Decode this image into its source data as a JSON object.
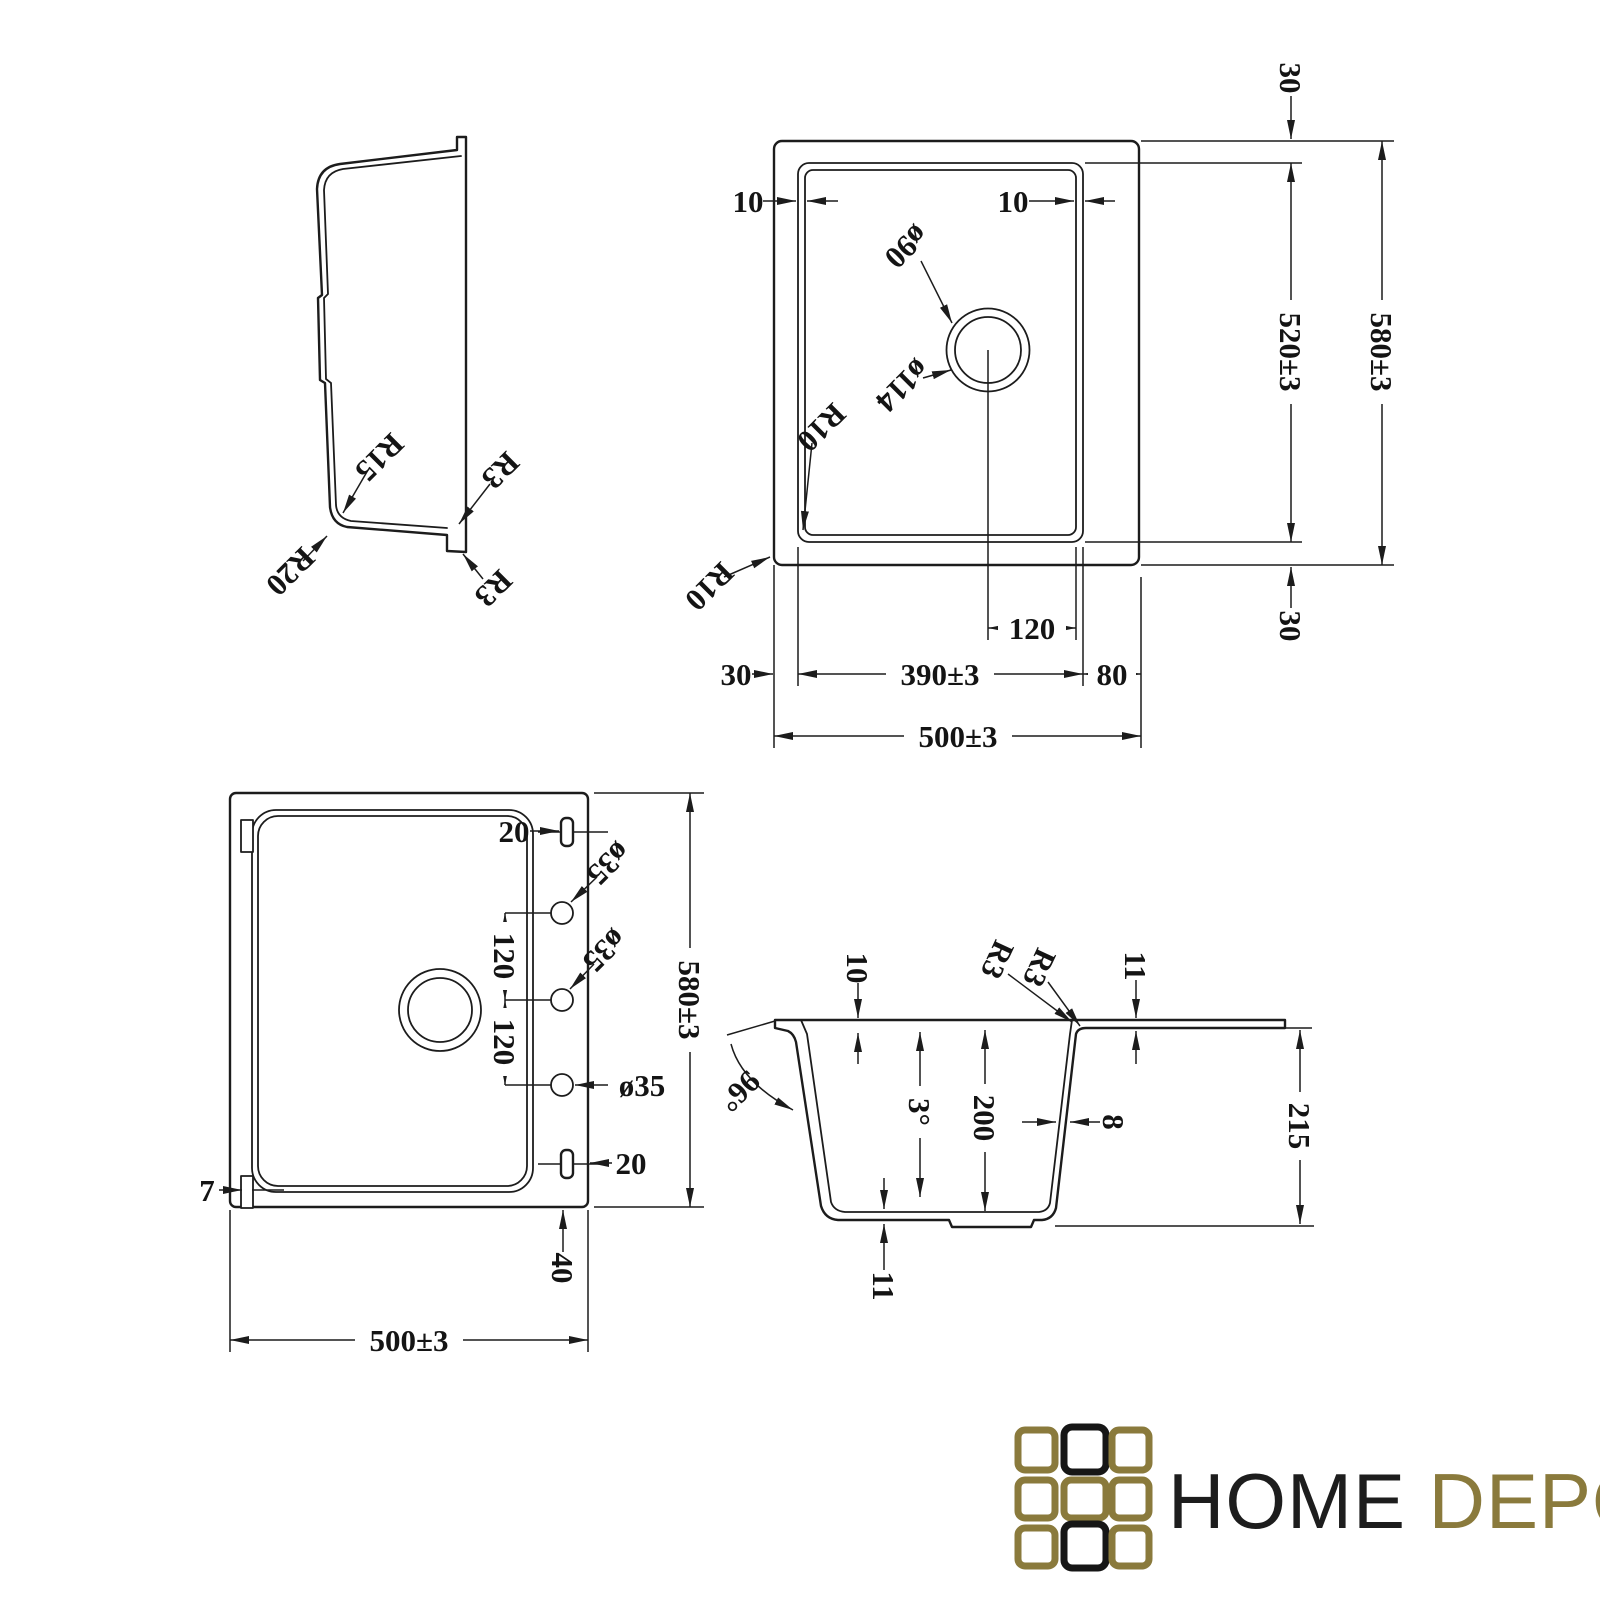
{
  "drawing": {
    "background": "#ffffff",
    "line_color": "#1c1c1c",
    "side_profile": {
      "r15": "R15",
      "r20": "R20",
      "r3_upper": "R3",
      "r3_lower": "R3"
    },
    "top_plan": {
      "offset_top": "30",
      "inner_height": "520±3",
      "outer_height": "580±3",
      "offset_bottom": "30",
      "rim_left": "10",
      "rim_right": "10",
      "drain_hole": "ø90",
      "drain_outer": "ø114",
      "corner_bowl": "R10",
      "corner_outer": "R10",
      "drain_offset": "120",
      "bowl_width": "390±3",
      "right_offset": "80",
      "left_offset": "30",
      "outer_width": "500±3"
    },
    "bottom_plan": {
      "slot_top": "20",
      "hole_top": "ø35",
      "hole_mid": "ø35",
      "hole_bottom": "ø35",
      "spacing_top": "120",
      "spacing_bottom": "120",
      "outer_height": "580±3",
      "tab": "7",
      "slot_bottom": "20",
      "slot_offset": "40",
      "outer_width": "500±3"
    },
    "section": {
      "rim_inset": "10",
      "corner_a": "R3",
      "corner_b": "R3",
      "rim_thickness": "11",
      "wall_angle": "96°",
      "draft_angle": "3°",
      "bowl_depth": "200",
      "wall_thickness": "8",
      "total_height": "215",
      "bottom_thickness": "11"
    }
  },
  "logo": {
    "word_primary": "HOME",
    "word_secondary": "DEPO",
    "color_primary": "#1d1d1d",
    "color_secondary": "#8a7a3c",
    "grid": {
      "gold": "#8a7a3c",
      "black": "#161616",
      "pattern": [
        [
          "gold",
          "black",
          "gold"
        ],
        [
          "gold",
          "gold",
          "gold"
        ],
        [
          "gold",
          "black",
          "gold"
        ]
      ]
    }
  }
}
